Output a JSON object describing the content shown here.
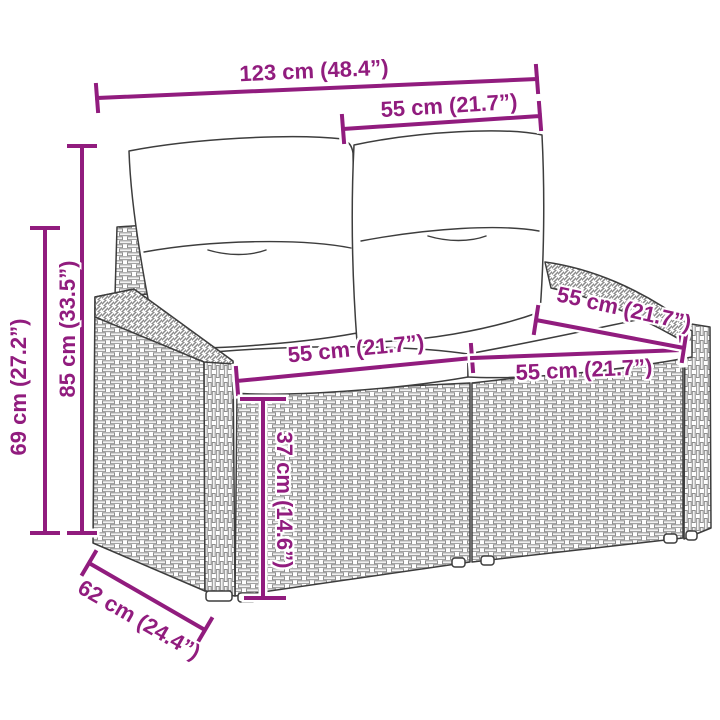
{
  "colors": {
    "accent": "#911c7e",
    "line_art": "#3d3d3d",
    "weave": "#8f8f8f"
  },
  "dims": {
    "overall_width": "123 cm (48.4”)",
    "backrest_width": "55 cm (21.7”)",
    "total_height": "85 cm (33.5”)",
    "armrest_height": "69 cm (27.2”)",
    "seat_width_left": "55 cm (21.7”)",
    "seat_width_right": "55 cm (21.7”)",
    "seat_depth": "55 cm (21.7”)",
    "seat_height": "37 cm (14.6”)",
    "overall_depth": "62 cm (24.4”)"
  }
}
